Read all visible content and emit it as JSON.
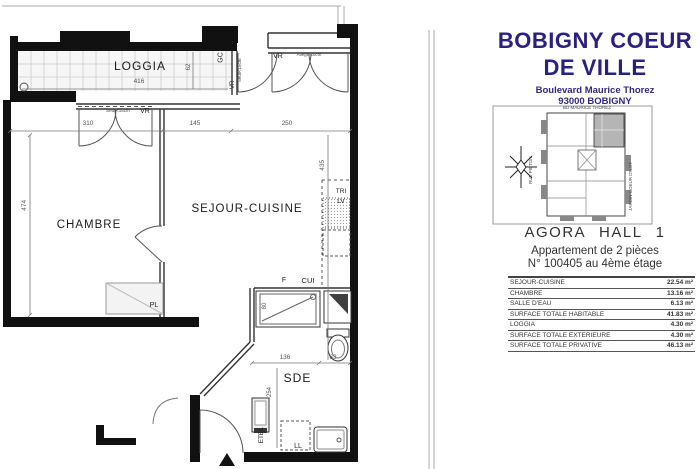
{
  "panel": {
    "title_line1": "BOBIGNY COEUR",
    "title_line2": "DE VILLE",
    "address_line1": "Boulevard Maurice Thorez",
    "address_line2": "93000 BOBIGNY",
    "keyplan": {
      "street_top": "BD MAURICE THOREZ",
      "street_left": "RUE PIETON",
      "garden_right": "JARDIN COEUR D'ILOT"
    },
    "building": "AGORA HALL 1",
    "apartment_type": "Appartement de 2 pièces",
    "apartment_number": "N° 100405 au 4ème étage",
    "surface_table": {
      "rows": [
        {
          "label": "SEJOUR-CUISINE",
          "value": "22.54 m²"
        },
        {
          "label": "CHAMBRE",
          "value": "13.16 m²"
        },
        {
          "label": "SALLE D'EAU",
          "value": "6.13 m²"
        },
        {
          "label": "SURFACE TOTALE HABITABLE",
          "value": "41.83 m²"
        },
        {
          "label": "LOGGIA",
          "value": "4.30 m²"
        },
        {
          "label": "SURFACE TOTALE EXTERIEURE",
          "value": "4.30 m²"
        },
        {
          "label": "SURFACE TOTALE PRIVATIVE",
          "value": "46.13 m²"
        }
      ]
    },
    "accent_color": "#2b2080"
  },
  "plan": {
    "rooms": {
      "loggia": "LOGGIA",
      "chambre": "CHAMBRE",
      "sejour_cuisine": "SEJOUR-CUISINE",
      "sde": "SDE"
    },
    "labels": {
      "gc": "GC",
      "vr": "VR",
      "seuil": "Seuil<15cm",
      "allege": "Allège 20cm",
      "tri": "TRI",
      "lv": "LV",
      "fridge": "F",
      "cui": "CUI",
      "pl": "PL",
      "etel": "ETEL",
      "ll": "LL"
    },
    "dims": {
      "loggia_width": "416",
      "loggia_depth": "62",
      "chambre_window": "310",
      "middle": "145",
      "sejour_window": "250",
      "chambre_depth": "474",
      "sejour_depth": "435",
      "shower": "80",
      "sde_width": "136",
      "sde_wc": "63",
      "sde_depth": "254"
    }
  }
}
